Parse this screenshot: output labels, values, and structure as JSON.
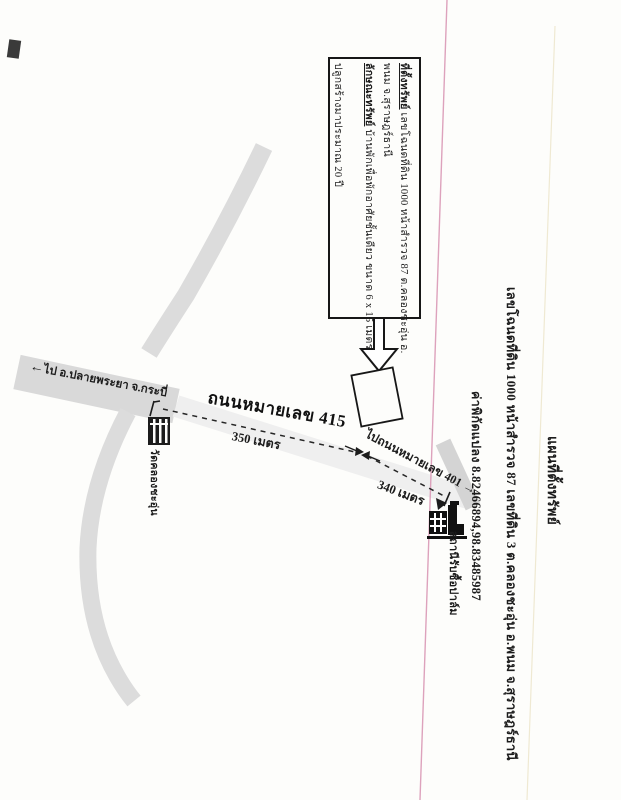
{
  "header": {
    "title": "แผนที่ตั้งทรัพย์",
    "deed_line": "เลขโฉนดที่ดิน 1000 หน้าสำรวจ 87 เลขที่ดิน 3 ต.คลองชะอุ่น อ.พนม จ.สุราษฎร์ธานี",
    "coords_line": "ค่าพิกัดแปลง 8.82466894,98.83485987"
  },
  "info_box": {
    "line1_label": "ที่ตั้งทรัพย์",
    "line1_text": " เลขโฉนดที่ดิน 1000 หน้าสำรวจ 87 ต.คลองชะอุ่น อ.",
    "line2": "พนม จ.สุราษฎร์ธานี",
    "line3_label": "ลักษณะทรัพย์",
    "line3_text": " บ้านพักเพื่อพักอาศัยชั้นเดียว ขนาด 6 x 15 เมตร",
    "line4": "ปลูกสร้างมาประมาณ 20 ปี"
  },
  "map": {
    "road_415_label": "ถนนหมายเลข 415",
    "to_plai_phraya_label": "ไป อ.ปลายพระยา จ.กระบี่",
    "to_road_401_label": "ไปถนนหมายเลข 401",
    "temple_label": "วัดคลองชะอุ่น",
    "palm_station_label": "สถานีรับซื้อปาล์ม",
    "distance_segment_1": "350 เมตร",
    "distance_segment_2": "340 เมตร"
  },
  "icons": {
    "arrow_left": "←",
    "arrow_right": "→"
  },
  "colors": {
    "road_fill": "#dcdcdc",
    "road_faint": "#ededed",
    "ink": "#1c1c1c",
    "pink_fold_line": "#d893b2",
    "beige_fold_line": "#efe9d2"
  }
}
